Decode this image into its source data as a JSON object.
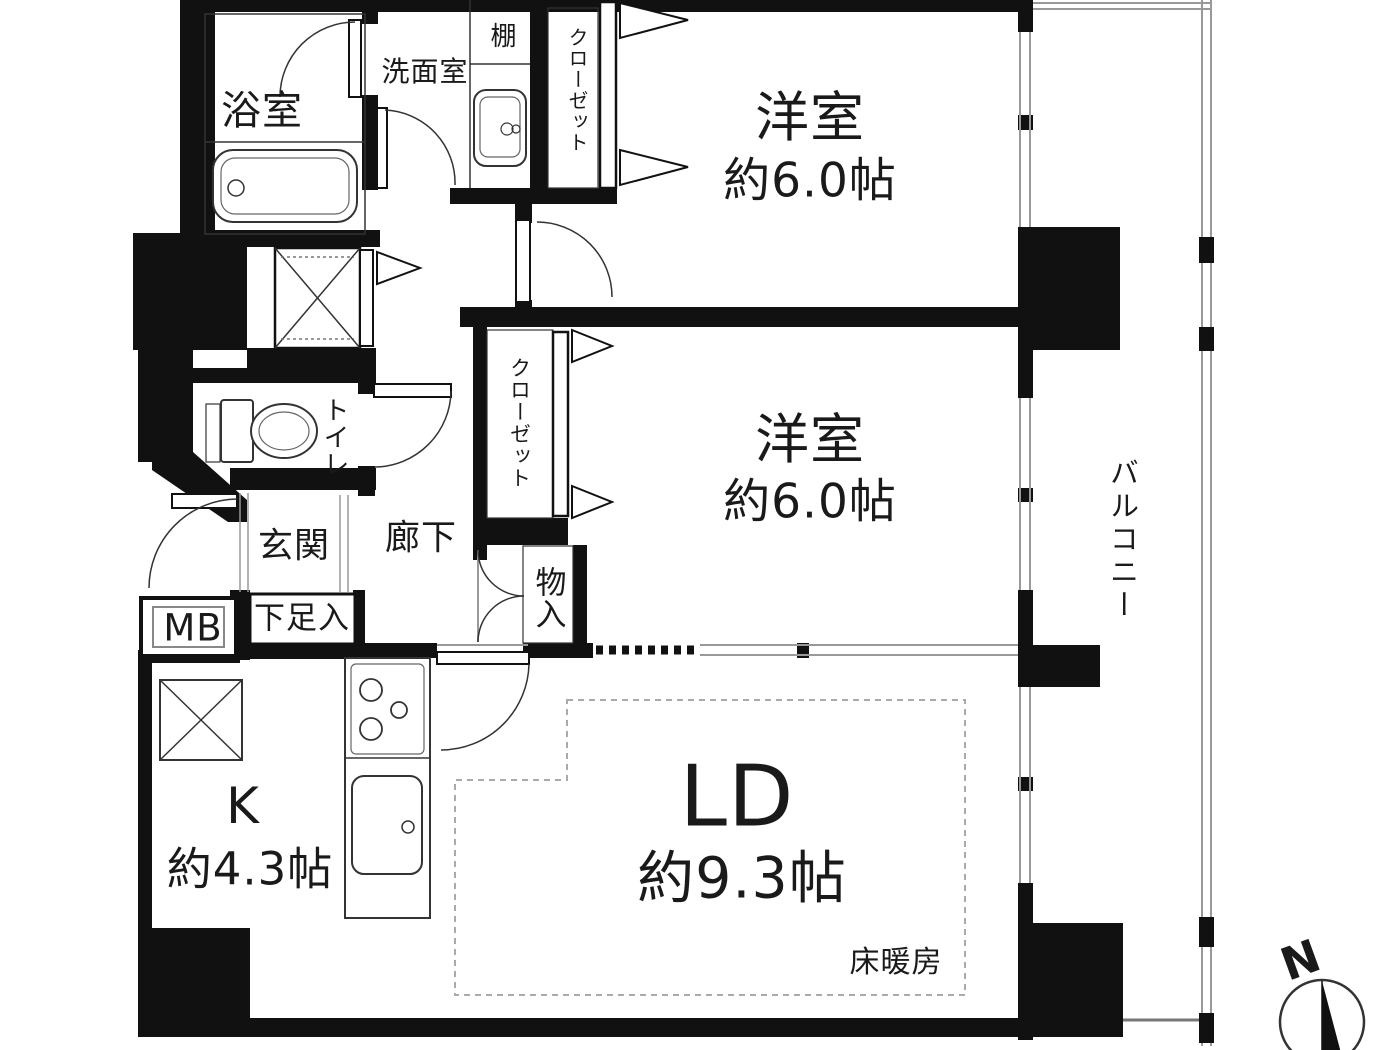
{
  "plan": {
    "rooms": {
      "bathroom": {
        "label": "浴室"
      },
      "washroom": {
        "label": "洗面室"
      },
      "shelf": {
        "label": "棚"
      },
      "closet_top": {
        "label": "クローゼット"
      },
      "bedroom_top": {
        "label": "洋室",
        "size": "約6.0帖"
      },
      "bedroom_middle": {
        "label": "洋室",
        "size": "約6.0帖"
      },
      "closet_middle": {
        "label": "クローゼット"
      },
      "storage": {
        "label": "物入"
      },
      "toilet": {
        "label": "トイレ"
      },
      "entrance": {
        "label": "玄関"
      },
      "hallway": {
        "label": "廊下"
      },
      "shoe_cabinet": {
        "label": "下足入"
      },
      "meter_box": {
        "label": "MB"
      },
      "kitchen": {
        "label": "K",
        "size": "約4.3帖"
      },
      "living_dining": {
        "label": "LD",
        "size": "約9.3帖",
        "floor_heating": "床暖房"
      },
      "balcony": {
        "label": "バルコニー"
      }
    },
    "compass": {
      "north_label": "N"
    },
    "colors": {
      "wall": "#111111",
      "fixture_line": "#333333",
      "thin_line": "#999999",
      "background": "#ffffff",
      "text": "#1a1a1a"
    }
  }
}
